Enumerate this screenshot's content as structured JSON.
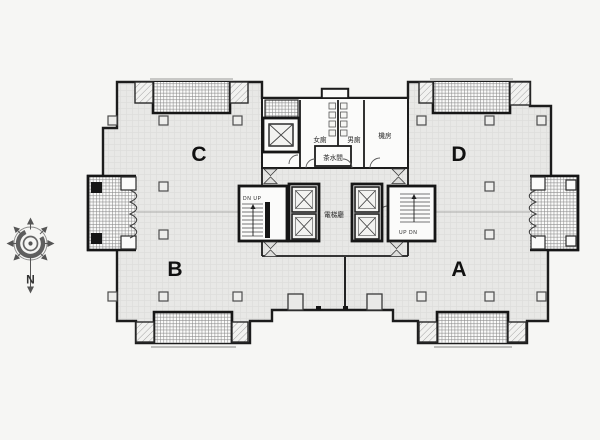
{
  "plan": {
    "zones": {
      "c": "C",
      "d": "D",
      "b": "B",
      "a": "A"
    },
    "core": {
      "womens_toilet": "女廁",
      "mens_toilet": "男廁",
      "machine_room": "機房",
      "pantry": "茶水間",
      "elevator_hall": "電梯廳",
      "stair_left_label": "DN UP",
      "stair_right_label": "UP DN"
    },
    "compass": {
      "north_label": "N"
    },
    "colors": {
      "background": "#f6f6f4",
      "floor": "#e8e8e6",
      "wall": "#1c1c1c",
      "hatch": "#8a8a8a"
    }
  }
}
